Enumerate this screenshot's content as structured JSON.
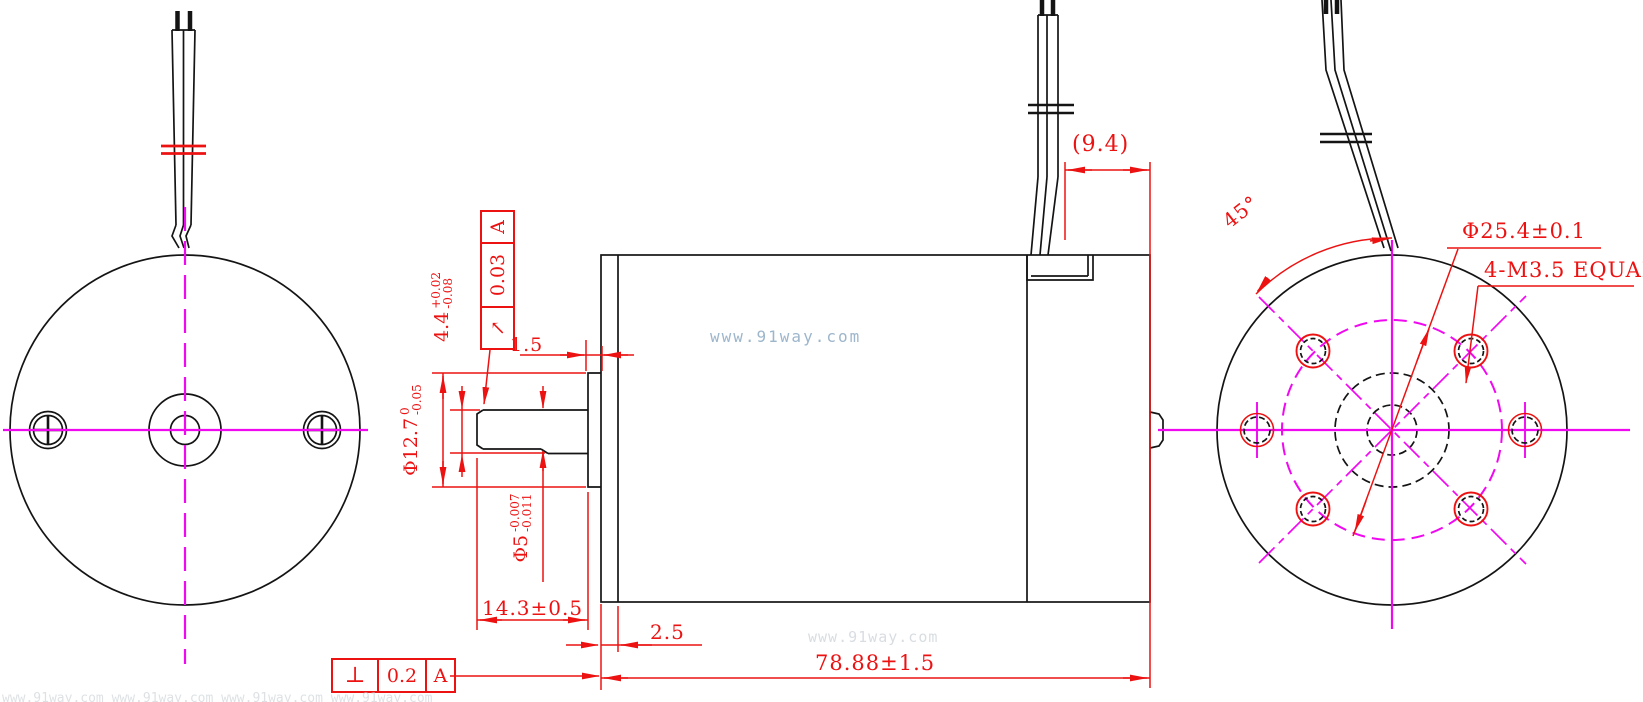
{
  "watermark": {
    "center": "www.91way.com",
    "faint": "www.91way.com",
    "bottom_strip": "www.91way.com   www.91way.com   www.91way.com   www.91way.com"
  },
  "dimensions": {
    "wire_offset": "(9.4)",
    "hole_angle": "45°",
    "bolt_circle": "Φ25.4±0.1",
    "mount_holes": "4-M3.5 EQUAL",
    "boss_thickness": "1.5",
    "shaft_protrusion": "14.3±0.5",
    "front_step": "2.5",
    "body_length": "78.88±1.5",
    "boss_dia": {
      "main": "Φ12.7",
      "upper": "0",
      "lower": "-0.05"
    },
    "shaft_flat": {
      "main": "4.4",
      "upper": "+0.02",
      "lower": "-0.08"
    },
    "shaft_dia": {
      "main": "Φ5",
      "upper": "-0.007",
      "lower": "-0.011"
    }
  },
  "gdt": {
    "runout": {
      "symbol": "↗",
      "value": "0.03",
      "datum": "A"
    },
    "perpendicularity": {
      "symbol": "⊥",
      "value": "0.2",
      "datum": "A"
    }
  },
  "colors": {
    "line": "#141414",
    "centerline": "#f008f0",
    "dimension": "#ec1212",
    "watermark": "#9db6cb"
  }
}
